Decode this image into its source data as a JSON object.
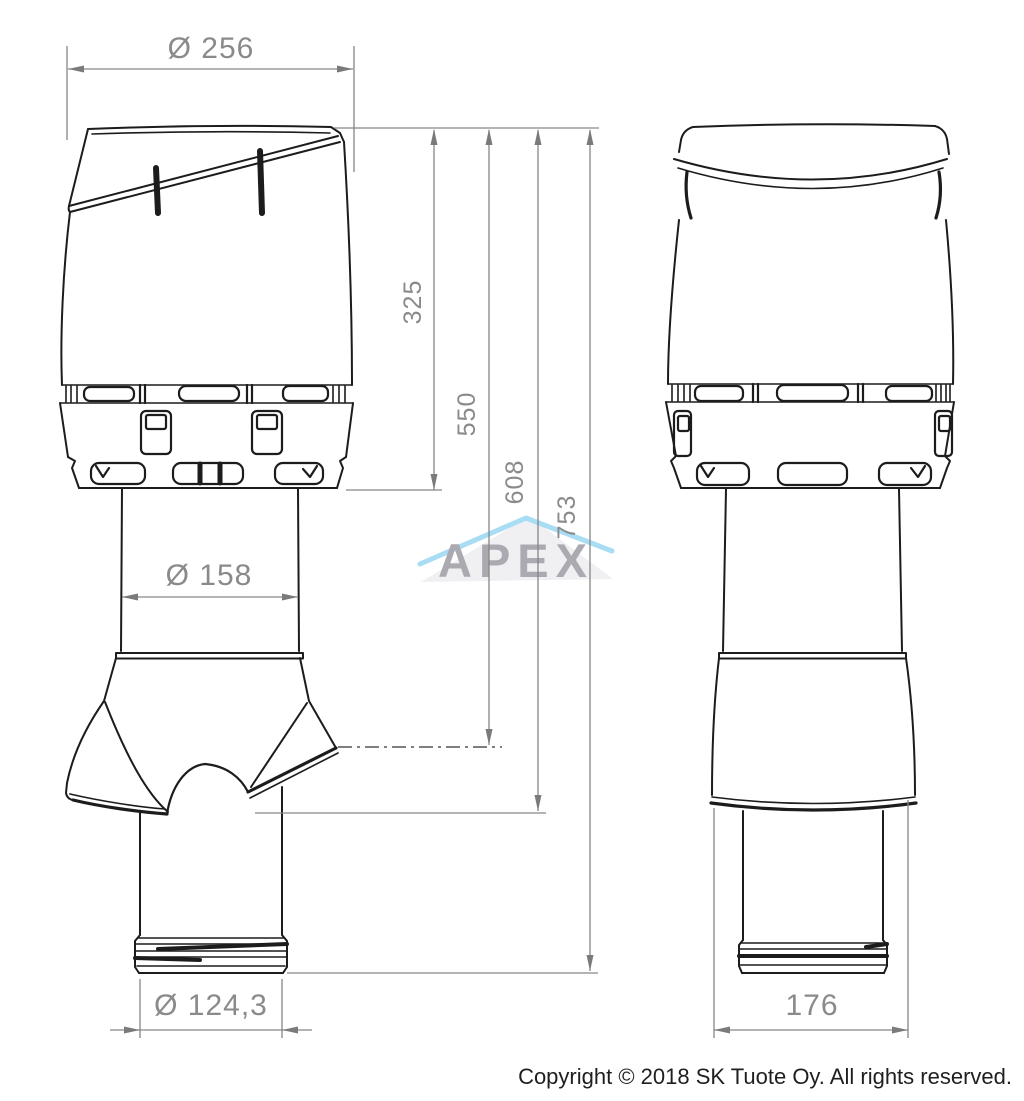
{
  "page": {
    "background_color": "#ffffff"
  },
  "drawing": {
    "subject": "roof-ventilation-outlet-two-view-technical-drawing",
    "line_color": "#1c1c1c",
    "dimension_line_color": "#868686",
    "dimension_text_color": "#8a8a8a",
    "views": [
      {
        "name": "front-view"
      },
      {
        "name": "side-view"
      }
    ],
    "dimensions": {
      "cap_width": "Ø 256",
      "cap_height": "325",
      "height_to_boot_top": "550",
      "height_to_boot_bottom": "608",
      "total_height": "753",
      "pipe_diameter": "Ø 158",
      "outlet_diameter": "Ø 124,3",
      "boot_width": "176"
    }
  },
  "watermark": {
    "text": "APEX",
    "letter_color": "#aaaab0",
    "swoosh_color": "#a8ddf3",
    "triangle_color": "#f0f0f3"
  },
  "footer": {
    "copyright": "Copyright © 2018 SK Tuote Oy. All rights reserved."
  }
}
